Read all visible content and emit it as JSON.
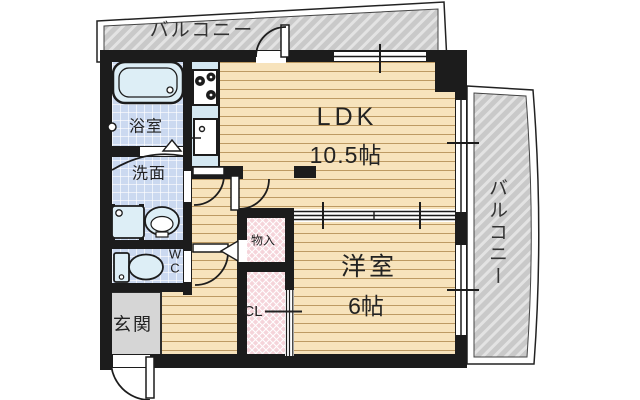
{
  "plan": {
    "type": "apartment-floor-plan",
    "rooms": {
      "balcony_top": {
        "label": "バルコニー"
      },
      "balcony_right": {
        "label": "バルコニー"
      },
      "ldk": {
        "label": "LDK",
        "size": "10.5帖"
      },
      "western_room": {
        "label": "洋室",
        "size": "6帖"
      },
      "bathroom": {
        "label": "浴室"
      },
      "washroom": {
        "label": "洗面"
      },
      "toilet": {
        "line1": "W",
        "line2": "C"
      },
      "entrance": {
        "label": "玄関"
      },
      "storage": {
        "label": "物入"
      },
      "closet": {
        "label": "CL"
      }
    },
    "colors": {
      "wall": "#1c1c1c",
      "wood_floor": "#f7e3bc",
      "wood_line": "#bd9a63",
      "tile_blue": "#cbd9f0",
      "kitchen_blue": "#d4e8f2",
      "fixture_fill": "#ddeef6",
      "balcony_gray": "#c9c9c9",
      "closet_pink": "#f5d4da",
      "entrance_gray": "#d6d6d6"
    }
  }
}
